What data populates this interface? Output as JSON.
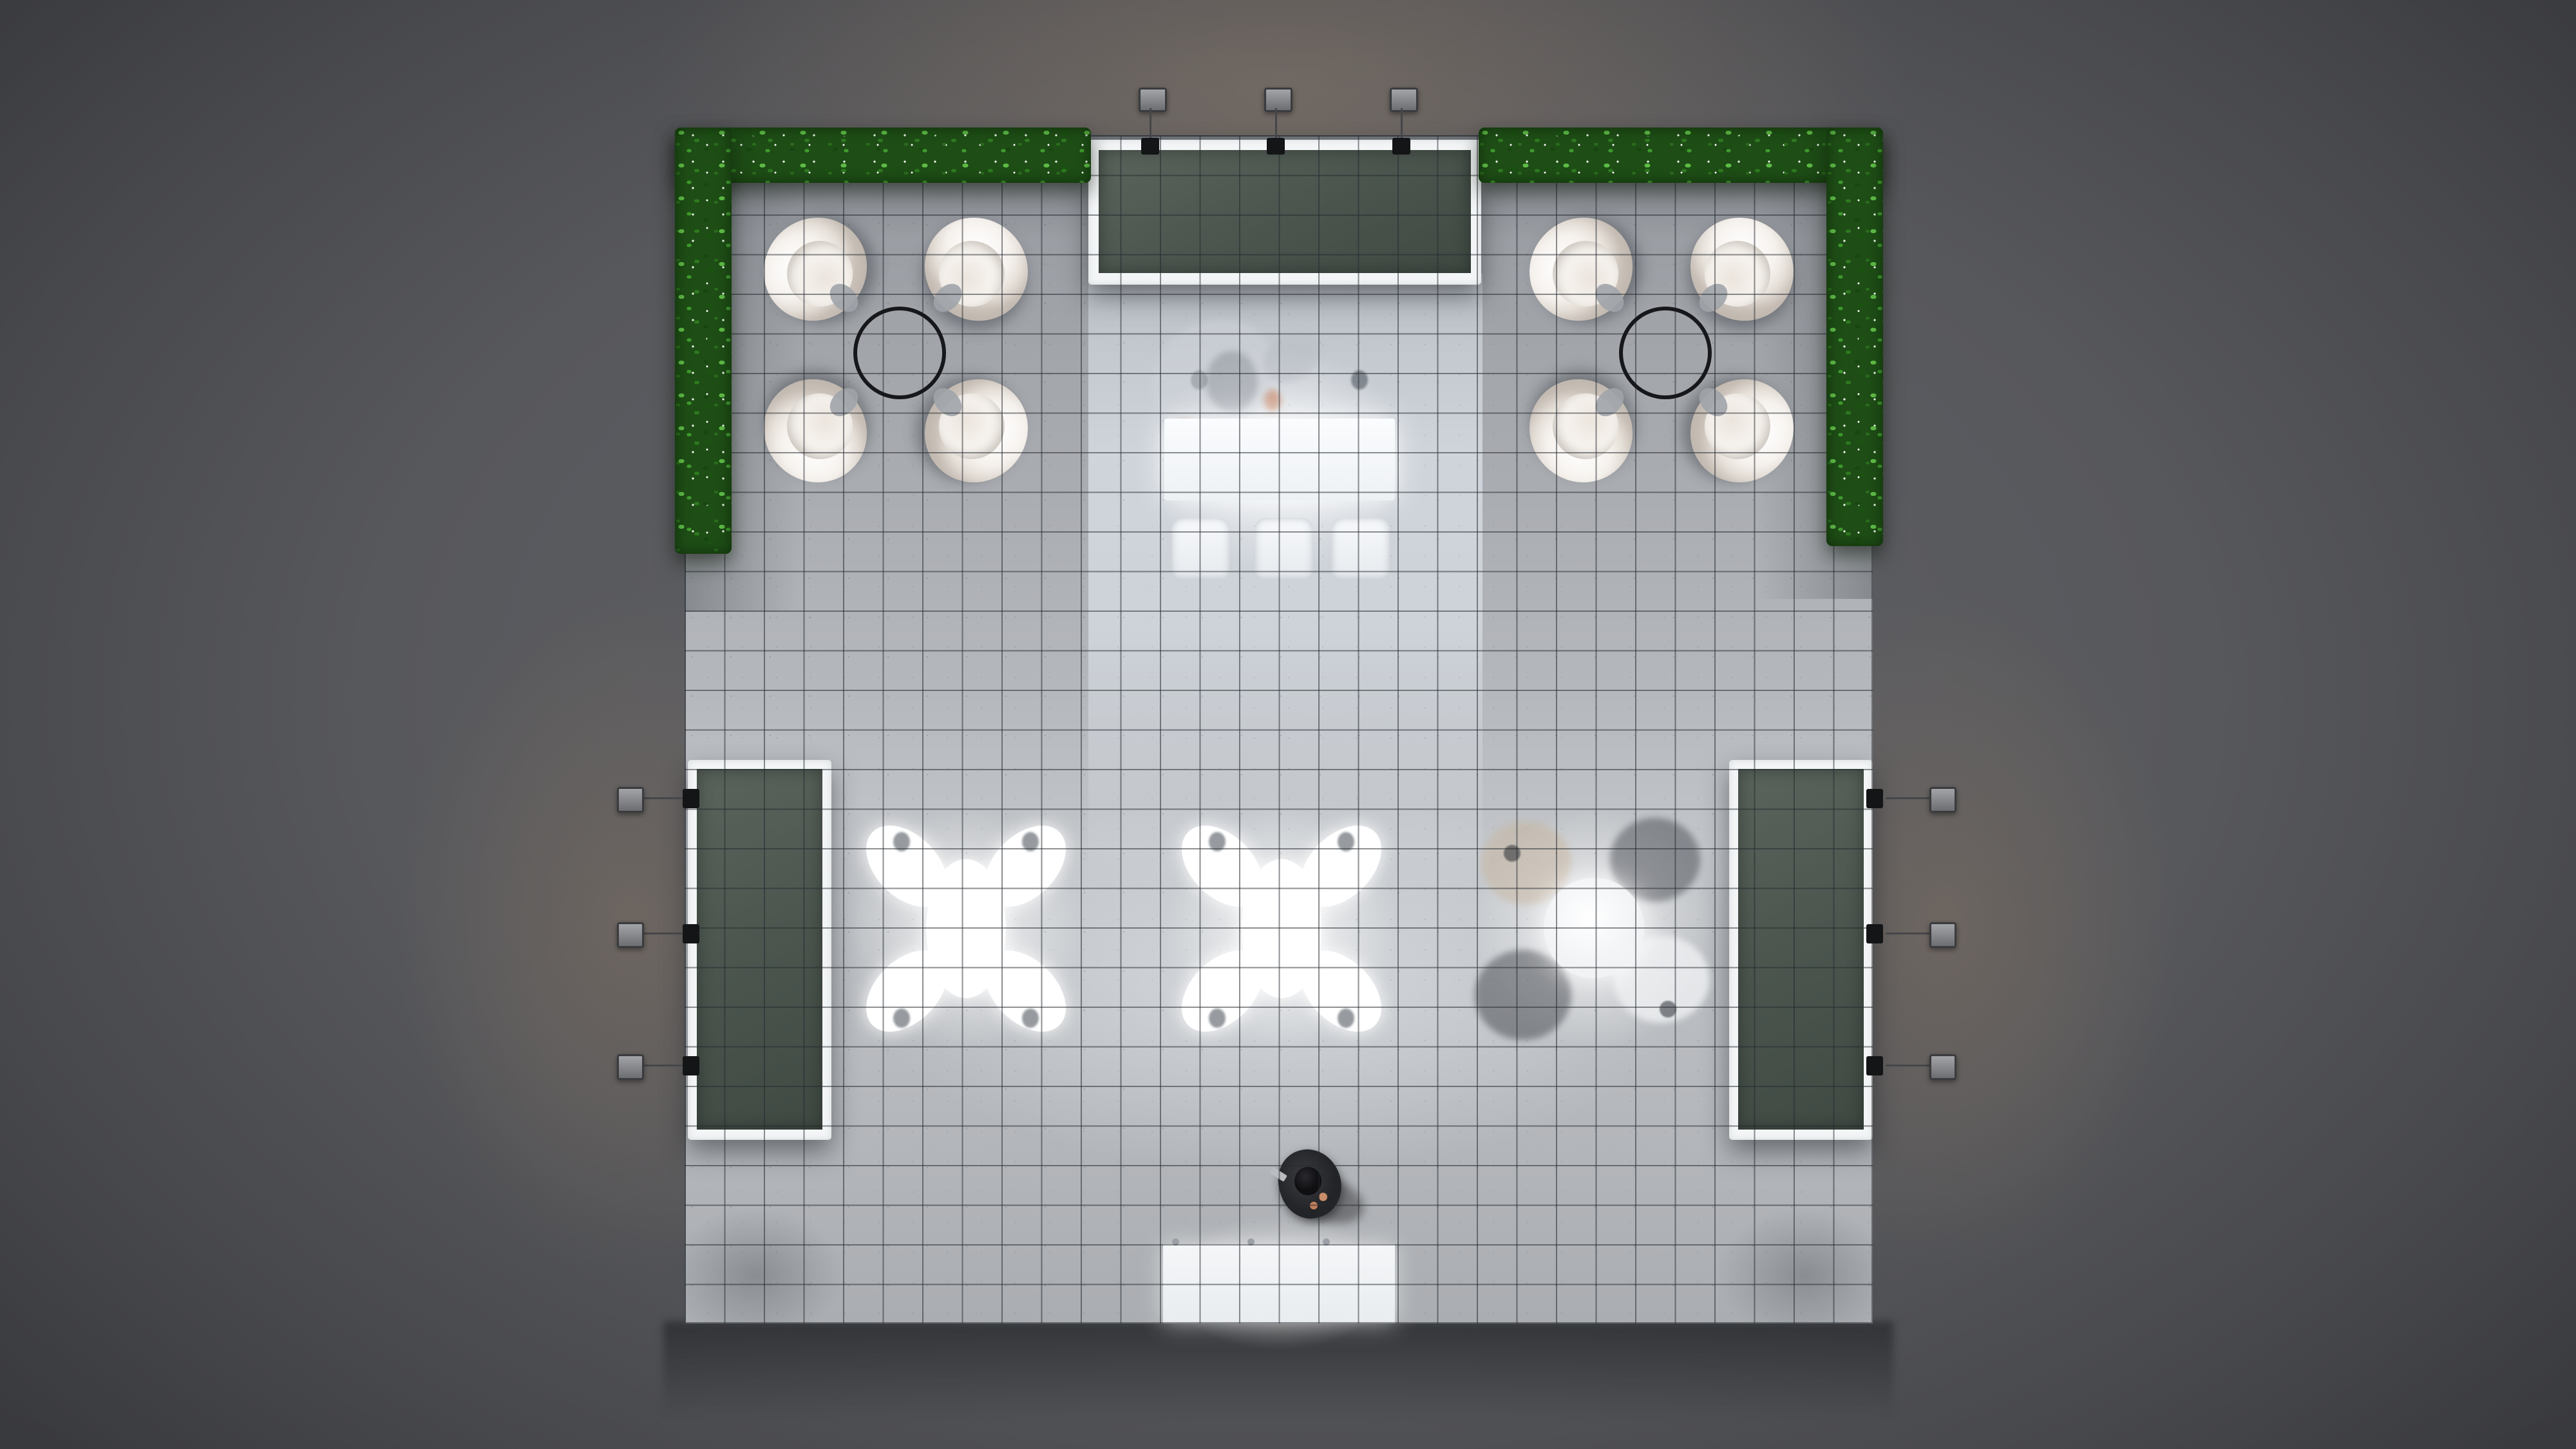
{
  "scene": {
    "label": "Top-down 3D render of a square exhibition booth floor on a dark studio backdrop",
    "view": "top-down",
    "backdrop_color": "#57585c",
    "vignette_color": "#0d0e11",
    "floor_color": "#b4b7bb",
    "grid_color": "#24292f",
    "floor_tiles_per_side": 30
  },
  "hedges": {
    "label": "L-shaped boxwood hedge borders at the two top corners",
    "count": 4,
    "colors": {
      "dark": "#1e4d16",
      "mid": "#2e7a20",
      "light": "#5dbb45",
      "bloom": "#ffffff"
    }
  },
  "panels": {
    "back_counter": {
      "label": "Back wall counter with white frame and dark green top",
      "frame_color": "#f3f5f6",
      "top_color": "#4c564f"
    },
    "left_side_table": {
      "label": "Left side table with white frame and dark green top"
    },
    "right_side_table": {
      "label": "Right side table with white frame and dark green top"
    }
  },
  "lounge": {
    "label": "Lounge armchair cluster around a black ring coffee table",
    "clusters": 2,
    "chairs_per_cluster": 4,
    "chair_color": "#f6f2ee",
    "coffee_table_ring_color": "#17181b"
  },
  "meeting": {
    "x_tables": {
      "label": "Brightly lit cafe table with four chairs in X layout",
      "count": 2
    },
    "round_table": {
      "label": "Round white table with faint seated figures",
      "count": 1,
      "seated_figures": 3,
      "empty_chairs": 1
    }
  },
  "lights": {
    "label": "Arm-mounted spotlights clamped to the panels",
    "top_count": 3,
    "left_count": 3,
    "right_count": 3,
    "head_color": "#8f9093",
    "glow_color": "#94806c"
  },
  "reception": {
    "desk_label": "Glowing white reception desk",
    "chair_count": 3,
    "ghost_label": "Faint translucent figure standing at the desk"
  },
  "entrance": {
    "mat_label": "White entrance mat at the bottom edge",
    "visitor_label": "Visitor in a dark suit walking near the entrance",
    "visitor_suit_color": "#2b2d30"
  }
}
